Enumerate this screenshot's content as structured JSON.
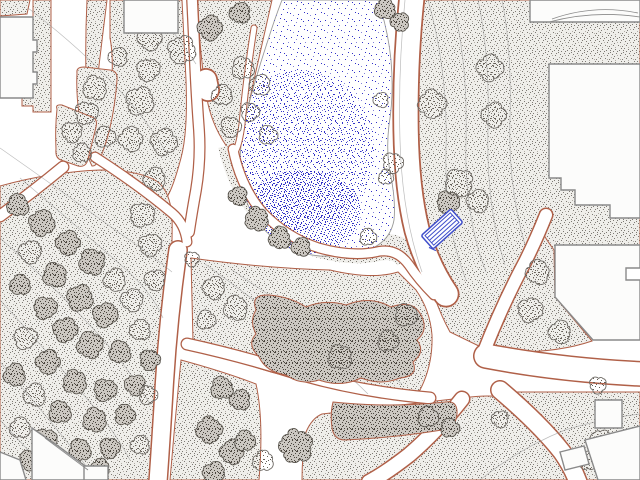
{
  "app": {
    "title": "Landscape site plan drawing",
    "canvas": {
      "w": 640,
      "h": 480,
      "background": "#ffffff"
    }
  },
  "palette": {
    "bed_outline": "#b06048",
    "bed_bg": "#efeeea",
    "bed_dot": "#7e7a74",
    "bed_dot_light": "#b3aea7",
    "tree_dot": "#655f57",
    "tree_stroke": "#6f6b66",
    "dark_bg": "#ccc8c2",
    "dark_dot": "#4a453e",
    "dark_stroke": "#5a564f",
    "water_dot": "#3232c8",
    "water_dot_light": "#8585da",
    "pond_outline": "#9a9a98",
    "building_fill": "#fcfcfb",
    "building_stroke": "#8a8a8a",
    "contour": "#8f8f8f",
    "walk_fill": "#ffffff",
    "bench_blue": "#3f4ecb"
  },
  "features": {
    "beds": [
      {
        "name": "bed-corner-nw",
        "d": "M0,0 L30,0 L27,14 L0,16 Z"
      },
      {
        "name": "bed-strip-west",
        "d": "M33,0 L51,0 L51,112 L33,112 L33,106 L22,106 L22,96 L33,96 Z"
      },
      {
        "name": "bed-wedge-north",
        "d": "M87,0 L107,0 Q99,64 92,126 L88,126 Q84,62 87,0 Z"
      },
      {
        "name": "bed-central-north",
        "d": "M110,0 L182,0 L186,80 Q188,132 181,158 Q173,188 167,197 Q159,204 149,196 L101,161 Q94,155 98,146 Q107,118 111,92 Q114,58 110,38 Z"
      },
      {
        "name": "bed-pond-west",
        "d": "M198,0 L272,0 Q263,40 254,80 Q247,112 242,142 Q238,160 230,151 Q214,130 208,104 Q199,54 198,0 Z"
      },
      {
        "name": "bed-oval-a",
        "d": "M77,73 Q76,67 84,67 L110,70 Q118,71 117,80 Q114,120 104,148 Q98,167 92,166 Q84,150 79,114 Q76,92 77,73 Z"
      },
      {
        "name": "bed-oval-b",
        "d": "M57,109 Q55,104 62,105 L92,117 Q98,119 96,127 L88,159 Q86,168 78,166 L61,160 Q55,158 56,149 Q55,128 57,109 Z"
      },
      {
        "name": "bed-east-large",
        "d": "M412,0 L640,0 L640,252 L548,252 L536,232 Q520,262 502,300 Q490,325 483,348 L450,332 Q428,292 418,230 Q406,186 405,130 Q404,60 412,0 Z"
      },
      {
        "name": "bed-east-triangle",
        "d": "M542,232 Q548,242 554,250 L555,297 L592,341 Q560,352 516,352 L486,352 Q497,320 515,285 Q528,258 542,232 Z"
      },
      {
        "name": "bed-southeast",
        "d": "M512,392 L640,392 L640,480 L584,480 Q556,436 530,410 Z"
      },
      {
        "name": "bed-south-center",
        "d": "M306,432 Q312,418 322,414 Q410,404 462,398 Q492,394 504,398 Q524,414 544,440 Q560,462 570,480 L302,480 Q302,455 306,432 Z"
      },
      {
        "name": "bed-south-left",
        "d": "M181,360 Q225,372 256,384 Q264,420 259,480 L170,480 Q175,420 181,360 Z"
      },
      {
        "name": "bed-mid-shrub",
        "d": "M191,258 Q262,268 330,270 Q372,280 398,272 L416,290 Q430,310 432,335 Q433,365 420,390 Q408,396 398,394 Q330,388 271,372 Q226,359 193,341 Z"
      },
      {
        "name": "bed-forest-west",
        "d": "M0,186 Q50,172 100,170 Q140,170 158,182 Q170,192 172,216 Q173,252 168,302 Q163,360 158,420 Q155,456 149,480 L0,480 Z"
      }
    ],
    "pond_rim_band": {
      "d": "M231,145 Q240,185 262,210 Q286,234 320,245 Q353,254 379,248 Q398,244 408,258",
      "width": 26
    },
    "pond": {
      "d": "M282,0 L378,0 Q388,30 391,60 Q394,95 389,125 Q386,150 390,172 Q396,200 394,220 Q390,242 368,250 Q345,257 320,256 Q295,254 276,240 Q258,227 248,205 Q240,185 240,160 Q241,130 250,100 Q258,70 268,40 Q275,18 282,0 Z",
      "medium_zone": {
        "cx": 300,
        "cy": 150,
        "rx": 74,
        "ry": 80
      },
      "dense_zone": {
        "cx": 303,
        "cy": 212,
        "rx": 58,
        "ry": 42
      }
    },
    "walks": [
      {
        "name": "walk-main-north",
        "d": "M412,-4 Q405,60 406,130 Q407,190 417,230 Q427,266 446,294",
        "outer": 27,
        "inner": 23.5
      },
      {
        "name": "walk-upper-left",
        "d": "M192,-3 L194,40 Q196,90 199,130 Q201,160 196,190 Q192,212 189,232",
        "outer": 12,
        "inner": 9.5
      },
      {
        "name": "walk-bulb",
        "d": "M206,80 L208,90",
        "outer": 24,
        "inner": 20.5
      },
      {
        "name": "walk-plaza-diagonal",
        "d": "M95,157 Q140,186 172,213 Q185,224 187,242",
        "outer": 11,
        "inner": 8.5
      },
      {
        "name": "walk-southwest",
        "d": "M178,250 Q168,320 164,390 Q161,440 158,482",
        "outer": 20,
        "inner": 17
      },
      {
        "name": "walk-pond-west",
        "d": "M254,28 Q246,80 242,124 Q239,148 234,153",
        "outer": 7,
        "inner": 5
      },
      {
        "name": "walk-pond-south",
        "d": "M233,149 Q241,188 263,213 Q287,238 319,248 Q351,257 376,252 Q396,247 409,265 Q419,280 434,295",
        "outer": 11,
        "inner": 8.5
      },
      {
        "name": "walk-west-junction",
        "d": "M187,344 Q242,356 302,375 Q362,392 430,398",
        "outer": 13,
        "inner": 10.5
      },
      {
        "name": "walk-east",
        "d": "M486,356 Q560,370 642,374",
        "outer": 26,
        "inner": 23
      },
      {
        "name": "walk-northeast",
        "d": "M483,354 Q502,305 525,262 Q536,240 546,215",
        "outer": 15,
        "inner": 12
      },
      {
        "name": "walk-southeast",
        "d": "M500,390 Q540,424 562,452 Q572,466 578,482",
        "outer": 20,
        "inner": 17
      },
      {
        "name": "walk-south",
        "d": "M462,399 Q436,432 409,455 Q386,473 369,482",
        "outer": 17,
        "inner": 14
      },
      {
        "name": "walk-west-edge",
        "d": "M63,167 Q34,191 0,216",
        "outer": 13,
        "inner": 10.5
      }
    ],
    "contours": [
      "M28,8 Q70,40 104,74 Q142,112 166,152",
      "M148,0 Q176,34 196,64",
      "M0,148 Q60,190 118,232 Q150,254 172,272",
      "M20,178 Q72,222 122,266 Q152,292 163,318",
      "M0,238 Q52,284 100,336 Q130,370 150,404",
      "M0,300 Q46,350 88,400 Q114,430 130,460",
      "M0,362 Q40,408 80,458 Q88,468 94,480",
      "M0,420 Q30,452 56,480",
      "M405,0 Q398,70 400,140 Q402,215 422,272",
      "M428,0 Q448,70 446,150 Q444,225 466,280",
      "M452,0 Q468,60 466,140 Q464,215 486,272",
      "M478,0 Q490,55 488,130 Q486,205 505,265",
      "M502,0 Q512,50 510,120 Q508,185 525,245",
      "M205,264 Q255,300 305,340 Q342,368 368,394",
      "M232,270 Q282,304 332,336 Q372,362 402,384",
      "M480,480 Q520,448 565,430 Q605,418 640,414"
    ],
    "shrub_masses": [
      {
        "name": "shrub-center",
        "d": "M256,310 Q250,294 269,295 Q291,297 306,307 Q325,299 346,305 Q370,295 391,307 Q413,299 421,315 Q429,330 417,340 Q426,352 413,362 Q419,376 400,378 Q381,386 361,378 Q341,388 319,380 Q301,386 286,375 Q266,372 259,357 Q246,344 256,334 Q249,321 256,310 Z"
      },
      {
        "name": "shrub-south",
        "d": "M333,402 Q390,408 445,402 Q458,400 457,414 Q456,428 442,430 Q392,438 345,440 Q334,440 332,428 Q330,414 333,402 Z"
      }
    ],
    "trees": [
      [
        150,
        38,
        13,
        "L"
      ],
      [
        118,
        57,
        10,
        "L"
      ],
      [
        148,
        70,
        12,
        "L"
      ],
      [
        140,
        101,
        15,
        "L"
      ],
      [
        131,
        139,
        13,
        "L"
      ],
      [
        164,
        142,
        14,
        "L"
      ],
      [
        155,
        179,
        12,
        "L"
      ],
      [
        182,
        50,
        15,
        "L"
      ],
      [
        210,
        28,
        13,
        "D"
      ],
      [
        240,
        13,
        11,
        "D"
      ],
      [
        222,
        95,
        11,
        "L"
      ],
      [
        231,
        127,
        11,
        "L"
      ],
      [
        243,
        68,
        12,
        "L"
      ],
      [
        260,
        85,
        11,
        "L"
      ],
      [
        250,
        112,
        10,
        "L"
      ],
      [
        268,
        135,
        10,
        "L"
      ],
      [
        238,
        196,
        10,
        "D"
      ],
      [
        257,
        219,
        13,
        "D"
      ],
      [
        280,
        238,
        12,
        "D"
      ],
      [
        301,
        247,
        10,
        "D"
      ],
      [
        385,
        9,
        11,
        "D"
      ],
      [
        400,
        22,
        10,
        "D"
      ],
      [
        381,
        100,
        8,
        "L"
      ],
      [
        393,
        163,
        11,
        "L"
      ],
      [
        386,
        177,
        8,
        "L"
      ],
      [
        368,
        237,
        9,
        "L"
      ],
      [
        448,
        202,
        12,
        "D"
      ],
      [
        490,
        68,
        14,
        "L"
      ],
      [
        432,
        104,
        15,
        "L"
      ],
      [
        494,
        115,
        13,
        "L"
      ],
      [
        459,
        183,
        15,
        "L"
      ],
      [
        478,
        201,
        12,
        "L"
      ],
      [
        95,
        88,
        13,
        "L"
      ],
      [
        86,
        113,
        12,
        "L"
      ],
      [
        105,
        137,
        11,
        "L"
      ],
      [
        72,
        132,
        11,
        "L"
      ],
      [
        82,
        153,
        10,
        "L"
      ],
      [
        214,
        288,
        12,
        "L"
      ],
      [
        236,
        308,
        13,
        "L"
      ],
      [
        206,
        320,
        10,
        "L"
      ],
      [
        340,
        357,
        13,
        "L"
      ],
      [
        406,
        315,
        12,
        "L"
      ],
      [
        388,
        341,
        11,
        "L"
      ],
      [
        192,
        259,
        8,
        "L"
      ],
      [
        538,
        272,
        13,
        "L"
      ],
      [
        530,
        310,
        13,
        "L"
      ],
      [
        560,
        332,
        12,
        "L"
      ],
      [
        598,
        385,
        9,
        "L"
      ],
      [
        601,
        440,
        11,
        "L"
      ],
      [
        588,
        461,
        10,
        "L"
      ],
      [
        428,
        417,
        11,
        "D"
      ],
      [
        450,
        428,
        10,
        "D"
      ],
      [
        500,
        419,
        9,
        "L"
      ],
      [
        296,
        446,
        18,
        "D"
      ],
      [
        222,
        388,
        12,
        "D"
      ],
      [
        240,
        400,
        11,
        "D"
      ],
      [
        209,
        430,
        14,
        "D"
      ],
      [
        232,
        452,
        13,
        "D"
      ],
      [
        214,
        473,
        12,
        "D"
      ],
      [
        245,
        441,
        11,
        "D"
      ],
      [
        263,
        461,
        11,
        "L"
      ],
      [
        18,
        205,
        12,
        "D"
      ],
      [
        42,
        223,
        14,
        "D"
      ],
      [
        68,
        243,
        13,
        "D"
      ],
      [
        30,
        252,
        12,
        "L"
      ],
      [
        92,
        262,
        14,
        "D"
      ],
      [
        55,
        275,
        13,
        "D"
      ],
      [
        115,
        280,
        12,
        "L"
      ],
      [
        20,
        285,
        11,
        "D"
      ],
      [
        80,
        298,
        14,
        "D"
      ],
      [
        45,
        308,
        12,
        "D"
      ],
      [
        105,
        315,
        13,
        "D"
      ],
      [
        132,
        300,
        12,
        "L"
      ],
      [
        65,
        330,
        13,
        "D"
      ],
      [
        25,
        338,
        12,
        "L"
      ],
      [
        90,
        345,
        14,
        "D"
      ],
      [
        120,
        352,
        12,
        "D"
      ],
      [
        48,
        362,
        13,
        "D"
      ],
      [
        140,
        330,
        11,
        "L"
      ],
      [
        15,
        375,
        12,
        "D"
      ],
      [
        75,
        382,
        13,
        "D"
      ],
      [
        105,
        390,
        12,
        "D"
      ],
      [
        35,
        395,
        12,
        "L"
      ],
      [
        135,
        385,
        11,
        "D"
      ],
      [
        60,
        412,
        12,
        "D"
      ],
      [
        95,
        420,
        13,
        "D"
      ],
      [
        20,
        428,
        11,
        "L"
      ],
      [
        125,
        415,
        11,
        "D"
      ],
      [
        45,
        440,
        12,
        "D"
      ],
      [
        80,
        450,
        12,
        "D"
      ],
      [
        110,
        448,
        11,
        "D"
      ],
      [
        140,
        445,
        10,
        "L"
      ],
      [
        30,
        460,
        11,
        "D"
      ],
      [
        65,
        468,
        11,
        "D"
      ],
      [
        100,
        468,
        10,
        "D"
      ],
      [
        142,
        215,
        13,
        "L"
      ],
      [
        150,
        245,
        12,
        "L"
      ],
      [
        155,
        280,
        11,
        "L"
      ],
      [
        150,
        360,
        11,
        "D"
      ],
      [
        148,
        395,
        10,
        "L"
      ]
    ],
    "buildings": [
      {
        "name": "building-west",
        "d": "M0,17 L33,17 L33,40 L37,40 L37,52 L33,52 L33,72 L37,72 L37,84 L33,84 L33,98 L0,98 Z"
      },
      {
        "name": "building-north",
        "d": "M124,0 L178,0 L178,33 L124,33 Z"
      },
      {
        "name": "building-northeast",
        "d": "M530,0 L640,0 L640,22 L530,22 Z"
      },
      {
        "name": "building-east-steps",
        "d": "M549,64 L640,64 L640,218 L610,218 L610,205 L575,205 L575,190 L561,190 L561,178 L549,178 Z"
      },
      {
        "name": "building-east-lower",
        "d": "M555,245 L640,245 L640,268 L626,268 L626,280 L640,280 L640,340 L593,340 L555,297 Z"
      },
      {
        "name": "building-se-small",
        "d": "M595,400 L622,400 L622,428 L595,428 Z"
      },
      {
        "name": "building-se-corner",
        "d": "M585,440 L640,426 L640,480 L598,480 Z"
      },
      {
        "name": "building-se-tiny",
        "d": "M560,452 L584,446 L589,464 L565,470 Z"
      },
      {
        "name": "building-southwest",
        "d": "M32,428 L58,446 L104,480 L32,480 Z"
      },
      {
        "name": "building-sw-annex",
        "d": "M84,466 L108,466 L108,480 L84,480 Z"
      },
      {
        "name": "building-sw-corner",
        "d": "M0,452 L20,460 L26,480 L0,480 Z"
      }
    ],
    "building_details": [
      "M552,19 Q594,4 638,13",
      "M549,22 Q594,10 640,17",
      "M45,438 L88,470"
    ],
    "bench": {
      "cx": 442,
      "cy": 229,
      "length": 40,
      "width": 18,
      "angle": -42,
      "stripes": 3
    }
  }
}
